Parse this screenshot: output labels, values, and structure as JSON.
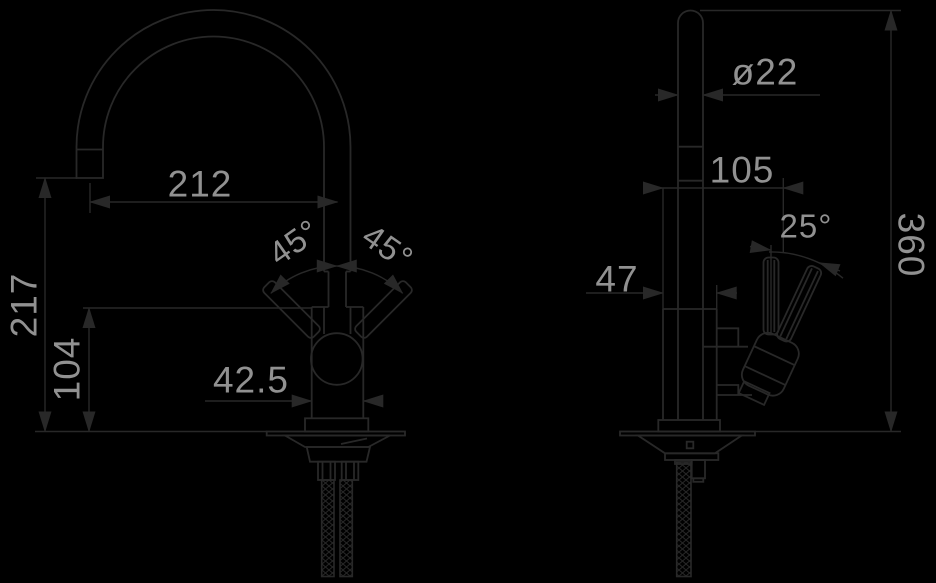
{
  "diagram": {
    "type": "technical-drawing",
    "colors": {
      "background": "#000000",
      "line": "#282828",
      "dimension_text": "#919191"
    },
    "front_view": {
      "spout_reach": "212",
      "spout_height": "217",
      "body_height": "104",
      "body_width": "42.5",
      "left_handle_angle": "45°",
      "right_handle_angle": "45°"
    },
    "side_view": {
      "spout_diameter": "ø22",
      "front_to_lever": "105",
      "lever_angle": "25°",
      "body_depth": "47",
      "overall_height": "360"
    }
  }
}
